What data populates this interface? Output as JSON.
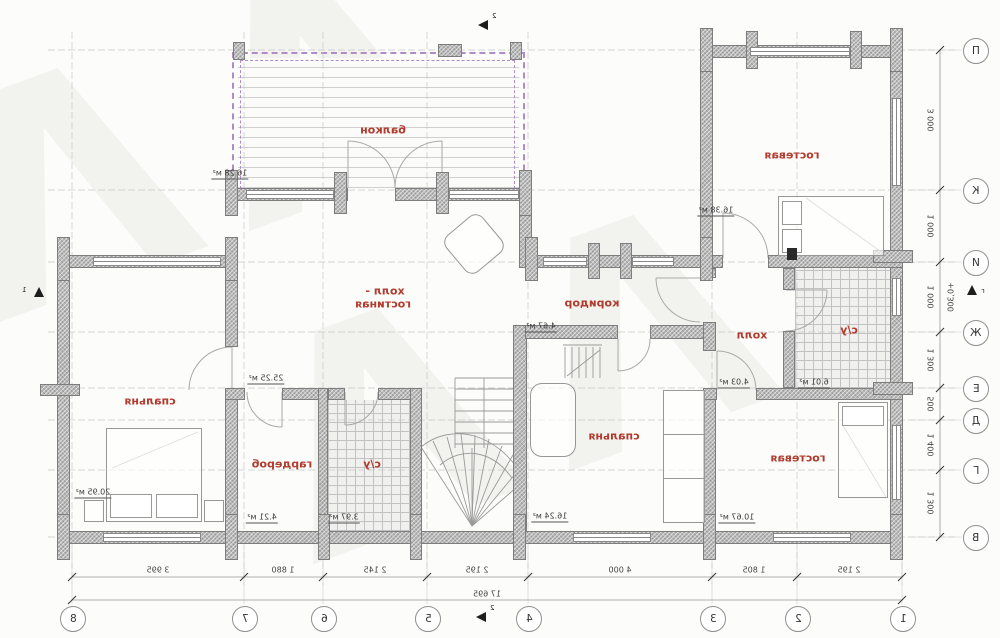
{
  "rooms": {
    "balcony": {
      "label": "балкон",
      "area": "16.28 м²"
    },
    "guest_top": {
      "label": "гостевая",
      "area": "16.38 м²"
    },
    "hall_living": {
      "label1": "холл -",
      "label2": "гостиная",
      "area": "25.25 м²"
    },
    "corridor": {
      "label": "коридор",
      "area": "4.67 м²"
    },
    "hall": {
      "label": "холл",
      "area": "4.03 м²"
    },
    "bath_right": {
      "label": "с/у",
      "area": "6.01 м²"
    },
    "bedroom_left": {
      "label": "спальня",
      "area": "20.95 м²"
    },
    "wardrobe": {
      "label": "гардероб",
      "area": "4.21 м²"
    },
    "bath_small": {
      "label": "с/у",
      "area": "3.97 м²"
    },
    "bedroom_center": {
      "label": "спальня",
      "area": "16.24 м²"
    },
    "guest_bottom": {
      "label": "гостевая",
      "area": "10.67 м²"
    }
  },
  "axes": {
    "bottom": [
      "8",
      "7",
      "6",
      "5",
      "4",
      "3",
      "2",
      "1"
    ],
    "right": [
      "П",
      "К",
      "И",
      "Ж",
      "Е",
      "Д",
      "Г",
      "В"
    ]
  },
  "dims": {
    "bottom": [
      "3 995",
      "1 880",
      "2 145",
      "2 195",
      "4 000",
      "1 805",
      "2 195"
    ],
    "bottom_total": "17 695",
    "right": [
      "3 000",
      "1 000",
      "1 000",
      "1 300",
      "500",
      "1 400",
      "1 300"
    ]
  },
  "level": {
    "value": "+0,300",
    "letter": "г"
  },
  "markers": {
    "left": "1",
    "top": "2",
    "bottom": "2"
  },
  "decor": {
    "watermark": "ΛΛ"
  },
  "colors": {
    "room_label": "#b23b2e",
    "balcony_rail": "#b08cc6",
    "wall": "#b7b7b7"
  }
}
